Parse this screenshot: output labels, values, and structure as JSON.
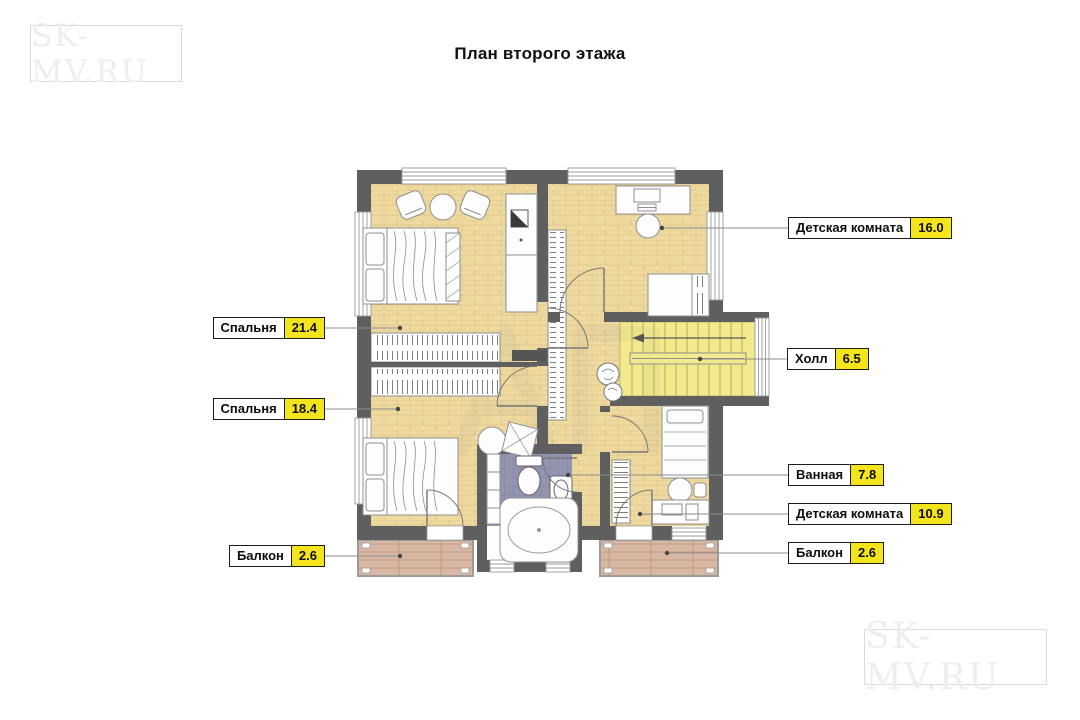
{
  "title": "План второго этажа",
  "logos": {
    "top_left": "SK-MV.RU",
    "bottom_right": "SK-MV.RU"
  },
  "labels": [
    {
      "name": "Спальня",
      "area": "21.4"
    },
    {
      "name": "Спальня",
      "area": "18.4"
    },
    {
      "name": "Балкон",
      "area": "2.6"
    },
    {
      "name": "Детская комната",
      "area": "16.0"
    },
    {
      "name": "Холл",
      "area": "6.5"
    },
    {
      "name": "Ванная",
      "area": "7.8"
    },
    {
      "name": "Детская комната",
      "area": "10.9"
    },
    {
      "name": "Балкон",
      "area": "2.6"
    }
  ],
  "colors": {
    "wall": "#5f5f5f",
    "wood_floor": "#eeda9f",
    "stairs_floor": "#f3e98d",
    "bathroom_tile": "#9294b0",
    "balcony_floor": "#d8b8a5",
    "label_highlight": "#f4e41c",
    "logo_gray": "#eceef2"
  }
}
